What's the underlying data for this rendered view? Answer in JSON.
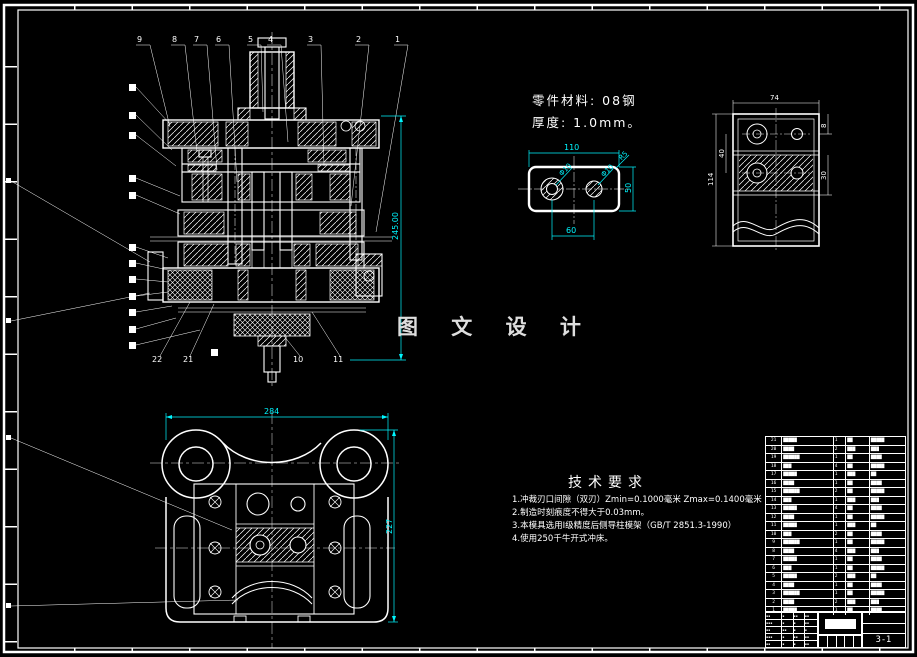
{
  "watermark": "图 文 设 计",
  "material_note": {
    "line1": "零件材料: 08钢",
    "line2": "厚度: 1.0mm。"
  },
  "tech_req": {
    "title": "技术要求",
    "items": [
      "1.冲裁刃口间隙（双刃）Zmin=0.1000毫米 Zmax=0.1400毫米",
      "2.制造时刻痕度不得大于0.03mm。",
      "3.本模具选用Ⅰ级精度后侧导柱模架（GB/T 2851.3-1990）",
      "4.使用250千牛开式冲床。"
    ]
  },
  "dims": {
    "front_height": "245.00",
    "plan_width": "284",
    "plan_height": "227",
    "part_width": "110",
    "part_hole_span": "60",
    "part_height": "50",
    "part_radius": "R5",
    "part_hole_left": "Φ10",
    "part_hole_right": "Φ10",
    "side_width": "74",
    "side_height": "114",
    "side_hole_offset": "40",
    "side_band": "30",
    "side_step": "8"
  },
  "balloons": {
    "top": [
      "9",
      "8",
      "7",
      "6",
      "5",
      "4",
      "3",
      "2",
      "1"
    ],
    "bottom": [
      "22",
      "21",
      "10",
      "11"
    ]
  },
  "titleblock": {
    "sheet_no": "3-1",
    "sig_rows": [
      [
        "▪▪",
        "▪",
        "▪▪",
        "▪▪"
      ],
      [
        "▪▪▪",
        "▪",
        "▪",
        "▪▪"
      ],
      [
        "▪▪",
        "▪▪",
        "▪",
        "▪"
      ],
      [
        "▪▪▪",
        "▪",
        "▪▪",
        "▪▪"
      ],
      [
        "▪▪",
        "▪",
        "▪",
        "▪▪"
      ]
    ]
  },
  "bom": {
    "rows": [
      {
        "no": "21",
        "name": "▇▇▇▇▇",
        "qty": "1",
        "mat": "▇▇",
        "std": "▇▇▇▇▇"
      },
      {
        "no": "20",
        "name": "▇▇▇▇",
        "qty": "2",
        "mat": "▇▇▇",
        "std": "▇▇▇"
      },
      {
        "no": "19",
        "name": "▇▇▇▇▇▇",
        "qty": "1",
        "mat": "▇▇",
        "std": "▇▇▇▇"
      },
      {
        "no": "18",
        "name": "▇▇▇",
        "qty": "4",
        "mat": "▇▇",
        "std": "▇▇▇▇▇"
      },
      {
        "no": "17",
        "name": "▇▇▇▇▇",
        "qty": "1",
        "mat": "▇▇▇",
        "std": "▇▇"
      },
      {
        "no": "16",
        "name": "▇▇▇▇",
        "qty": "1",
        "mat": "▇▇",
        "std": "▇▇▇▇"
      },
      {
        "no": "15",
        "name": "▇▇▇▇▇▇",
        "qty": "2",
        "mat": "▇▇",
        "std": "▇▇▇▇▇"
      },
      {
        "no": "14",
        "name": "▇▇▇",
        "qty": "1",
        "mat": "▇▇▇",
        "std": "▇▇▇"
      },
      {
        "no": "13",
        "name": "▇▇▇▇▇",
        "qty": "4",
        "mat": "▇▇",
        "std": "▇▇▇▇"
      },
      {
        "no": "12",
        "name": "▇▇▇▇",
        "qty": "1",
        "mat": "▇▇",
        "std": "▇▇▇▇▇"
      },
      {
        "no": "11",
        "name": "▇▇▇▇▇",
        "qty": "1",
        "mat": "▇▇▇",
        "std": "▇▇"
      },
      {
        "no": "10",
        "name": "▇▇▇",
        "qty": "2",
        "mat": "▇▇",
        "std": "▇▇▇▇"
      },
      {
        "no": "9",
        "name": "▇▇▇▇▇▇",
        "qty": "1",
        "mat": "▇▇",
        "std": "▇▇▇▇▇"
      },
      {
        "no": "8",
        "name": "▇▇▇▇",
        "qty": "4",
        "mat": "▇▇▇",
        "std": "▇▇▇"
      },
      {
        "no": "7",
        "name": "▇▇▇▇▇",
        "qty": "1",
        "mat": "▇▇",
        "std": "▇▇▇▇"
      },
      {
        "no": "6",
        "name": "▇▇▇",
        "qty": "1",
        "mat": "▇▇",
        "std": "▇▇▇▇▇"
      },
      {
        "no": "5",
        "name": "▇▇▇▇▇",
        "qty": "2",
        "mat": "▇▇▇",
        "std": "▇▇"
      },
      {
        "no": "4",
        "name": "▇▇▇▇",
        "qty": "1",
        "mat": "▇▇",
        "std": "▇▇▇▇"
      },
      {
        "no": "3",
        "name": "▇▇▇▇▇▇",
        "qty": "1",
        "mat": "▇▇",
        "std": "▇▇▇▇▇"
      },
      {
        "no": "2",
        "name": "▇▇▇▇",
        "qty": "2",
        "mat": "▇▇▇",
        "std": "▇▇▇"
      },
      {
        "no": "1",
        "name": "▇▇▇▇▇",
        "qty": "1",
        "mat": "▇▇",
        "std": "▇▇▇▇"
      }
    ]
  }
}
